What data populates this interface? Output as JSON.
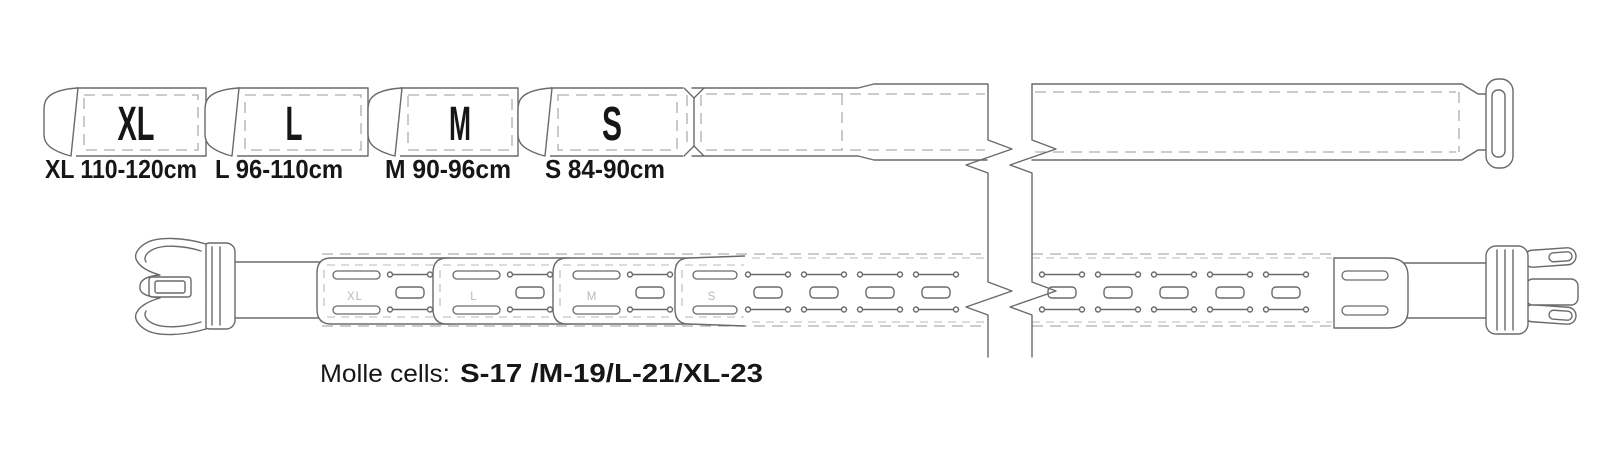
{
  "top_belt": {
    "segments": [
      {
        "label": "XL",
        "size_text": "XL 110-120cm"
      },
      {
        "label": "L",
        "size_text": "L 96-110cm"
      },
      {
        "label": "M",
        "size_text": "M 90-96cm"
      },
      {
        "label": "S",
        "size_text": "S 84-90cm"
      }
    ]
  },
  "bottom_belt": {
    "segment_labels": [
      "XL",
      "L",
      "M",
      "S"
    ]
  },
  "molle_note": {
    "prefix": "Molle cells:",
    "values": "S-17 /M-19/L-21/XL-23"
  },
  "colors": {
    "line": "#6a6a6a",
    "dashed_line": "#adadad",
    "panel_label_gray": "#b9b9b9",
    "text": "#161616",
    "background": "#ffffff"
  }
}
